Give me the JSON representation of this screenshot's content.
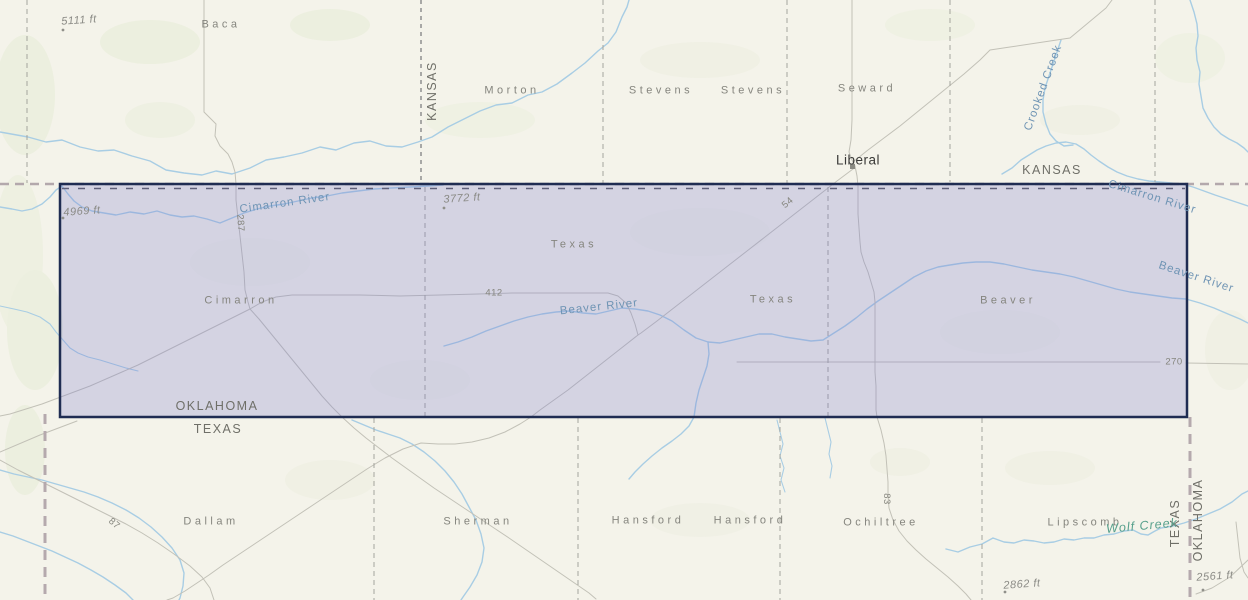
{
  "map": {
    "description": "Topographic basemap with Oklahoma Panhandle selection overlay",
    "selection": {
      "name": "oklahoma-panhandle-selection",
      "fill": "#7d7dd0",
      "fill_opacity": 0.27,
      "border_color": "#1f2c52",
      "bounds_px": {
        "left": 60,
        "top": 184,
        "right": 1187,
        "bottom": 417
      }
    },
    "colors": {
      "background": "#f4f3ea",
      "terrain_green": "#e6ecd6",
      "water": "#a8cde4",
      "road": "#c5c4ba",
      "county_line": "#a5a59d",
      "state_line": "#b3a8ac"
    },
    "labels": [
      {
        "name": "county-label-baca",
        "type": "county",
        "text": "Baca",
        "x": 221,
        "y": 25,
        "rot": 0
      },
      {
        "name": "county-label-morton",
        "type": "county",
        "text": "Morton",
        "x": 512,
        "y": 91,
        "rot": 0
      },
      {
        "name": "county-label-stevens-1",
        "type": "county",
        "text": "Stevens",
        "x": 661,
        "y": 91,
        "rot": 0
      },
      {
        "name": "county-label-stevens-2",
        "type": "county",
        "text": "Stevens",
        "x": 753,
        "y": 91,
        "rot": 0
      },
      {
        "name": "county-label-seward",
        "type": "county",
        "text": "Seward",
        "x": 867,
        "y": 89,
        "rot": 0
      },
      {
        "name": "county-label-cimarron",
        "type": "county",
        "text": "Cimarron",
        "x": 241,
        "y": 301,
        "rot": 0
      },
      {
        "name": "county-label-texas-1",
        "type": "county",
        "text": "Texas",
        "x": 574,
        "y": 245,
        "rot": 0
      },
      {
        "name": "county-label-texas-2",
        "type": "county",
        "text": "Texas",
        "x": 773,
        "y": 300,
        "rot": 0
      },
      {
        "name": "county-label-beaver",
        "type": "county",
        "text": "Beaver",
        "x": 1008,
        "y": 301,
        "rot": 0
      },
      {
        "name": "county-label-dallam",
        "type": "county",
        "text": "Dallam",
        "x": 211,
        "y": 522,
        "rot": 0
      },
      {
        "name": "county-label-sherman",
        "type": "county",
        "text": "Sherman",
        "x": 478,
        "y": 522,
        "rot": 0
      },
      {
        "name": "county-label-hansford-1",
        "type": "county",
        "text": "Hansford",
        "x": 648,
        "y": 521,
        "rot": 0
      },
      {
        "name": "county-label-hansford-2",
        "type": "county",
        "text": "Hansford",
        "x": 750,
        "y": 521,
        "rot": 0
      },
      {
        "name": "county-label-ochiltree",
        "type": "county",
        "text": "Ochiltree",
        "x": 881,
        "y": 523,
        "rot": 0
      },
      {
        "name": "county-label-lipscomb",
        "type": "county",
        "text": "Lipscomb",
        "x": 1085,
        "y": 523,
        "rot": 0
      },
      {
        "name": "state-label-kansas-west",
        "type": "state",
        "text": "KANSAS",
        "x": 432,
        "y": 91,
        "rot": -90
      },
      {
        "name": "state-label-kansas-east",
        "type": "state",
        "text": "KANSAS",
        "x": 1052,
        "y": 170,
        "rot": 0
      },
      {
        "name": "state-label-oklahoma-south",
        "type": "state",
        "text": "OKLAHOMA",
        "x": 217,
        "y": 406,
        "rot": 0
      },
      {
        "name": "state-label-texas-north",
        "type": "state",
        "text": "TEXAS",
        "x": 218,
        "y": 429,
        "rot": 0
      },
      {
        "name": "state-label-texas-east",
        "type": "state",
        "text": "TEXAS",
        "x": 1175,
        "y": 523,
        "rot": -90
      },
      {
        "name": "state-label-oklahoma-east",
        "type": "state",
        "text": "OKLAHOMA",
        "x": 1198,
        "y": 520,
        "rot": -90
      },
      {
        "name": "town-label-liberal",
        "type": "town",
        "text": "Liberal",
        "x": 858,
        "y": 160,
        "rot": 0
      },
      {
        "name": "elevation-label-5111",
        "type": "elev",
        "text": "5111 ft",
        "x": 79,
        "y": 21,
        "rot": -4
      },
      {
        "name": "elevation-label-4969",
        "type": "elev",
        "text": "4969 ft",
        "x": 82,
        "y": 212,
        "rot": -4
      },
      {
        "name": "elevation-label-3772",
        "type": "elev",
        "text": "3772 ft",
        "x": 462,
        "y": 199,
        "rot": -4
      },
      {
        "name": "elevation-label-2862",
        "type": "elev",
        "text": "2862 ft",
        "x": 1022,
        "y": 585,
        "rot": -4
      },
      {
        "name": "elevation-label-2561",
        "type": "elev",
        "text": "2561 ft",
        "x": 1215,
        "y": 577,
        "rot": -4
      },
      {
        "name": "river-label-cimarron-west",
        "type": "river",
        "text": "Cimarron River",
        "x": 285,
        "y": 204,
        "rot": -8
      },
      {
        "name": "river-label-cimarron-east",
        "type": "river",
        "text": "Cimarron River",
        "x": 1152,
        "y": 198,
        "rot": 17
      },
      {
        "name": "river-label-crooked-creek",
        "type": "river",
        "text": "Crooked Creek",
        "x": 1044,
        "y": 88,
        "rot": -70
      },
      {
        "name": "river-label-beaver-west",
        "type": "river",
        "text": "Beaver River",
        "x": 599,
        "y": 308,
        "rot": -6
      },
      {
        "name": "river-label-beaver-east",
        "type": "river",
        "text": "Beaver River",
        "x": 1196,
        "y": 278,
        "rot": 18
      },
      {
        "name": "river-label-wolf-creek",
        "type": "river-em",
        "text": "Wolf Creek",
        "x": 1142,
        "y": 526,
        "rot": -5
      },
      {
        "name": "highway-label-287",
        "type": "hwy",
        "text": "287",
        "x": 240,
        "y": 223,
        "rot": 87
      },
      {
        "name": "highway-label-412",
        "type": "hwy",
        "text": "412",
        "x": 494,
        "y": 293,
        "rot": 0
      },
      {
        "name": "highway-label-54",
        "type": "hwy",
        "text": "54",
        "x": 788,
        "y": 203,
        "rot": -40
      },
      {
        "name": "highway-label-270",
        "type": "hwy",
        "text": "270",
        "x": 1174,
        "y": 362,
        "rot": 0
      },
      {
        "name": "highway-label-87",
        "type": "hwy",
        "text": "87",
        "x": 114,
        "y": 524,
        "rot": 40
      },
      {
        "name": "highway-label-83",
        "type": "hwy",
        "text": "83",
        "x": 886,
        "y": 499,
        "rot": 90
      }
    ]
  }
}
